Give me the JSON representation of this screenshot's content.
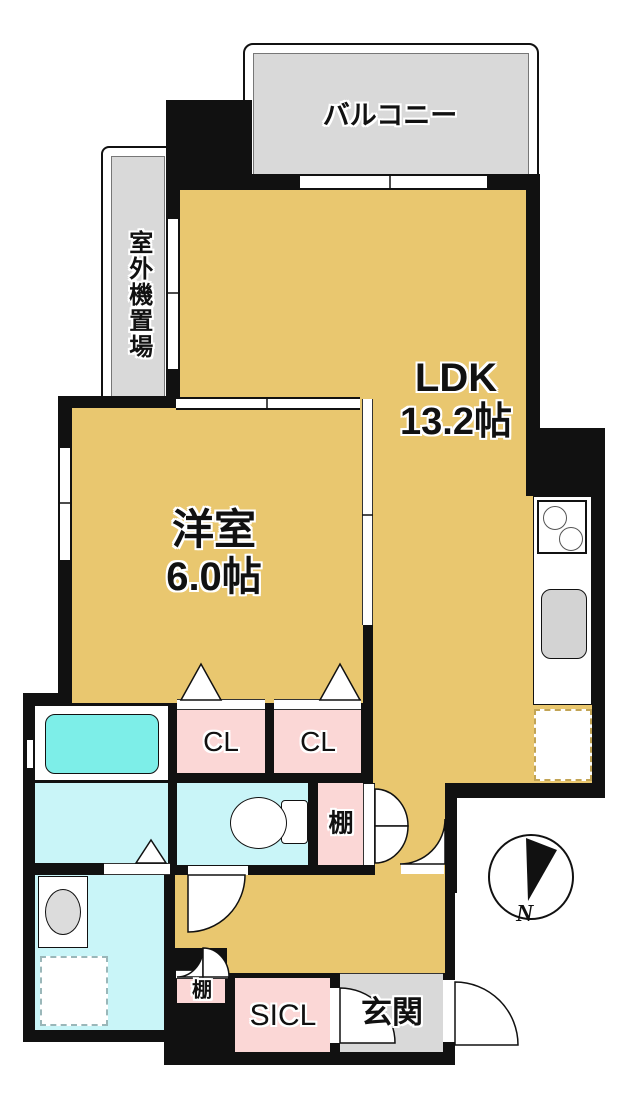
{
  "colors": {
    "wall": "#111111",
    "tan": "#e9c76f",
    "pink": "#fbd7d6",
    "cyan_light": "#c9f5f8",
    "cyan_tub": "#7deee8",
    "gray_area": "#d9d9d9",
    "gray_fixture": "#d3d3d3"
  },
  "labels": {
    "balcony": "バルコニー",
    "outdoor_unit": "室外機置場",
    "ldk": "LDK",
    "ldk_size": "13.2帖",
    "western_room": "洋室",
    "western_room_size": "6.0帖",
    "closet_1": "CL",
    "closet_2": "CL",
    "shelf_1": "棚",
    "shelf_2": "棚",
    "shoe_in_closet": "SICL",
    "entrance": "玄関",
    "north": "N"
  }
}
